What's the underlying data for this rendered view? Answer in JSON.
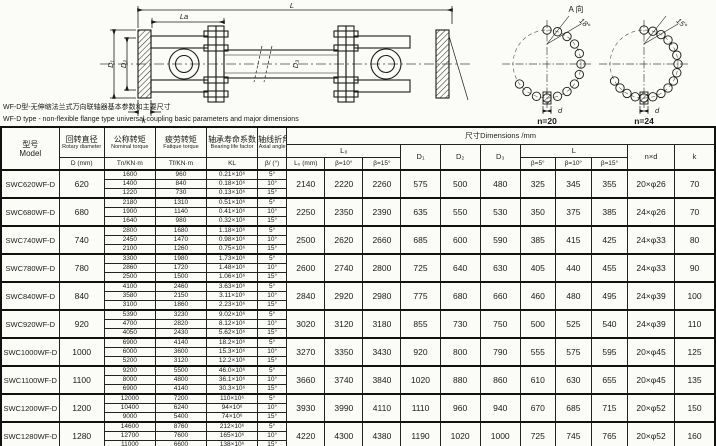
{
  "doc": {
    "caption_cn": "WF-D型-无伸缩法兰式万向联轴器基本参数和主要尺寸",
    "caption_en": "WF-D type - non-flexible flange type universal coupling basic parameters and major dimensions",
    "view_label": "A 向",
    "drawing_labels": {
      "overall_length": "L",
      "la": "La",
      "d1": "D₁",
      "d2": "D₂",
      "d3": "D₃",
      "k": "k",
      "hole_dia": "d",
      "n20": "n=20",
      "n24": "n=24",
      "angle_n20": "18°",
      "angle_n24": "15°"
    }
  },
  "table": {
    "headers": {
      "model_cn": "型号",
      "model_en": "Model",
      "rotary_cn": "回转直径",
      "rotary_en": "Rotary diameter",
      "rotary_unit": "D (mm)",
      "nominal_cn": "公称转矩",
      "nominal_en": "Nominal torque",
      "nominal_unit": "Tn/KN·m",
      "fatigue_cn": "疲劳转矩",
      "fatigue_en": "Fatique torque",
      "fatigue_unit": "Tf/KN·m",
      "bearing_cn": "轴承寿命系数",
      "bearing_en": "Bearing life factor",
      "bearing_unit": "KL",
      "axial_cn": "轴线折角",
      "axial_en": "Axial angle",
      "axial_unit": "β/ (°)",
      "dims_title": "尺寸Dimensions /mm",
      "l0_group": "L₀",
      "l0_sub": "L₀ (mm)",
      "b5": "β=5°",
      "b10": "β=10°",
      "b15": "β=15°",
      "d1": "D₁",
      "d2": "D₂",
      "d3": "D₃",
      "l_group": "L",
      "nxd": "n×d",
      "k": "k"
    },
    "rows": [
      {
        "model": "SWC620WF-D",
        "d": "620",
        "sub": [
          [
            "1600",
            "960",
            "0.21×10⁶",
            "5°"
          ],
          [
            "1400",
            "840",
            "0.18×10⁶",
            "10°"
          ],
          [
            "1220",
            "730",
            "0.13×10⁶",
            "15°"
          ]
        ],
        "dims": [
          "2140",
          "2220",
          "2260",
          "575",
          "500",
          "480",
          "325",
          "345",
          "355",
          "20×φ26",
          "70"
        ]
      },
      {
        "model": "SWC680WF-D",
        "d": "680",
        "sub": [
          [
            "2180",
            "1310",
            "0.51×10⁶",
            "5°"
          ],
          [
            "1900",
            "1140",
            "0.41×10⁶",
            "10°"
          ],
          [
            "1640",
            "980",
            "0.32×10⁶",
            "15°"
          ]
        ],
        "dims": [
          "2250",
          "2350",
          "2390",
          "635",
          "550",
          "530",
          "350",
          "375",
          "385",
          "24×φ26",
          "70"
        ]
      },
      {
        "model": "SWC740WF-D",
        "d": "740",
        "sub": [
          [
            "2800",
            "1680",
            "1.18×10⁶",
            "5°"
          ],
          [
            "2450",
            "1470",
            "0.98×10⁶",
            "10°"
          ],
          [
            "2100",
            "1260",
            "0.75×10⁶",
            "15°"
          ]
        ],
        "dims": [
          "2500",
          "2620",
          "2660",
          "685",
          "600",
          "590",
          "385",
          "415",
          "425",
          "24×φ33",
          "80"
        ]
      },
      {
        "model": "SWC780WF-D",
        "d": "780",
        "sub": [
          [
            "3300",
            "1980",
            "1.73×10⁶",
            "5°"
          ],
          [
            "2860",
            "1720",
            "1.48×10⁶",
            "10°"
          ],
          [
            "2500",
            "1500",
            "1.06×10⁶",
            "15°"
          ]
        ],
        "dims": [
          "2600",
          "2740",
          "2800",
          "725",
          "640",
          "630",
          "405",
          "440",
          "455",
          "24×φ33",
          "90"
        ]
      },
      {
        "model": "SWC840WF-D",
        "d": "840",
        "sub": [
          [
            "4100",
            "2460",
            "3.63×10⁶",
            "5°"
          ],
          [
            "3580",
            "2150",
            "3.11×10⁶",
            "10°"
          ],
          [
            "3100",
            "1860",
            "2.23×10⁶",
            "15°"
          ]
        ],
        "dims": [
          "2840",
          "2920",
          "2980",
          "775",
          "680",
          "660",
          "460",
          "480",
          "495",
          "24×φ39",
          "100"
        ]
      },
      {
        "model": "SWC920WF-D",
        "d": "920",
        "sub": [
          [
            "5390",
            "3230",
            "9.02×10⁶",
            "5°"
          ],
          [
            "4700",
            "2820",
            "8.12×10⁶",
            "10°"
          ],
          [
            "4050",
            "2430",
            "5.62×10⁶",
            "15°"
          ]
        ],
        "dims": [
          "3020",
          "3120",
          "3180",
          "855",
          "730",
          "750",
          "500",
          "525",
          "540",
          "24×φ39",
          "110"
        ]
      },
      {
        "model": "SWC1000WF-D",
        "d": "1000",
        "sub": [
          [
            "6900",
            "4140",
            "18.2×10⁶",
            "5°"
          ],
          [
            "6000",
            "3600",
            "15.3×10⁶",
            "10°"
          ],
          [
            "5200",
            "3120",
            "12.2×10⁶",
            "15°"
          ]
        ],
        "dims": [
          "3270",
          "3350",
          "3430",
          "920",
          "800",
          "790",
          "555",
          "575",
          "595",
          "20×φ45",
          "125"
        ]
      },
      {
        "model": "SWC1100WF-D",
        "d": "1100",
        "sub": [
          [
            "9200",
            "5500",
            "46.0×10⁶",
            "5°"
          ],
          [
            "8000",
            "4800",
            "36.1×10⁶",
            "10°"
          ],
          [
            "6900",
            "4140",
            "30.3×10⁶",
            "15°"
          ]
        ],
        "dims": [
          "3660",
          "3740",
          "3840",
          "1020",
          "880",
          "860",
          "610",
          "630",
          "655",
          "20×φ45",
          "135"
        ]
      },
      {
        "model": "SWC1200WF-D",
        "d": "1200",
        "sub": [
          [
            "12000",
            "7200",
            "110×10⁶",
            "5°"
          ],
          [
            "10400",
            "6240",
            "94×10⁶",
            "10°"
          ],
          [
            "9000",
            "5400",
            "74×10⁶",
            "15°"
          ]
        ],
        "dims": [
          "3930",
          "3990",
          "4110",
          "1110",
          "960",
          "940",
          "670",
          "685",
          "715",
          "20×φ52",
          "150"
        ]
      },
      {
        "model": "SWC1280WF-D",
        "d": "1280",
        "sub": [
          [
            "14600",
            "8760",
            "212×10⁶",
            "5°"
          ],
          [
            "12700",
            "7600",
            "165×10⁶",
            "10°"
          ],
          [
            "11000",
            "6600",
            "138×10⁶",
            "15°"
          ]
        ],
        "dims": [
          "4220",
          "4300",
          "4380",
          "1190",
          "1020",
          "1000",
          "725",
          "745",
          "765",
          "20×φ52",
          "160"
        ]
      }
    ]
  }
}
